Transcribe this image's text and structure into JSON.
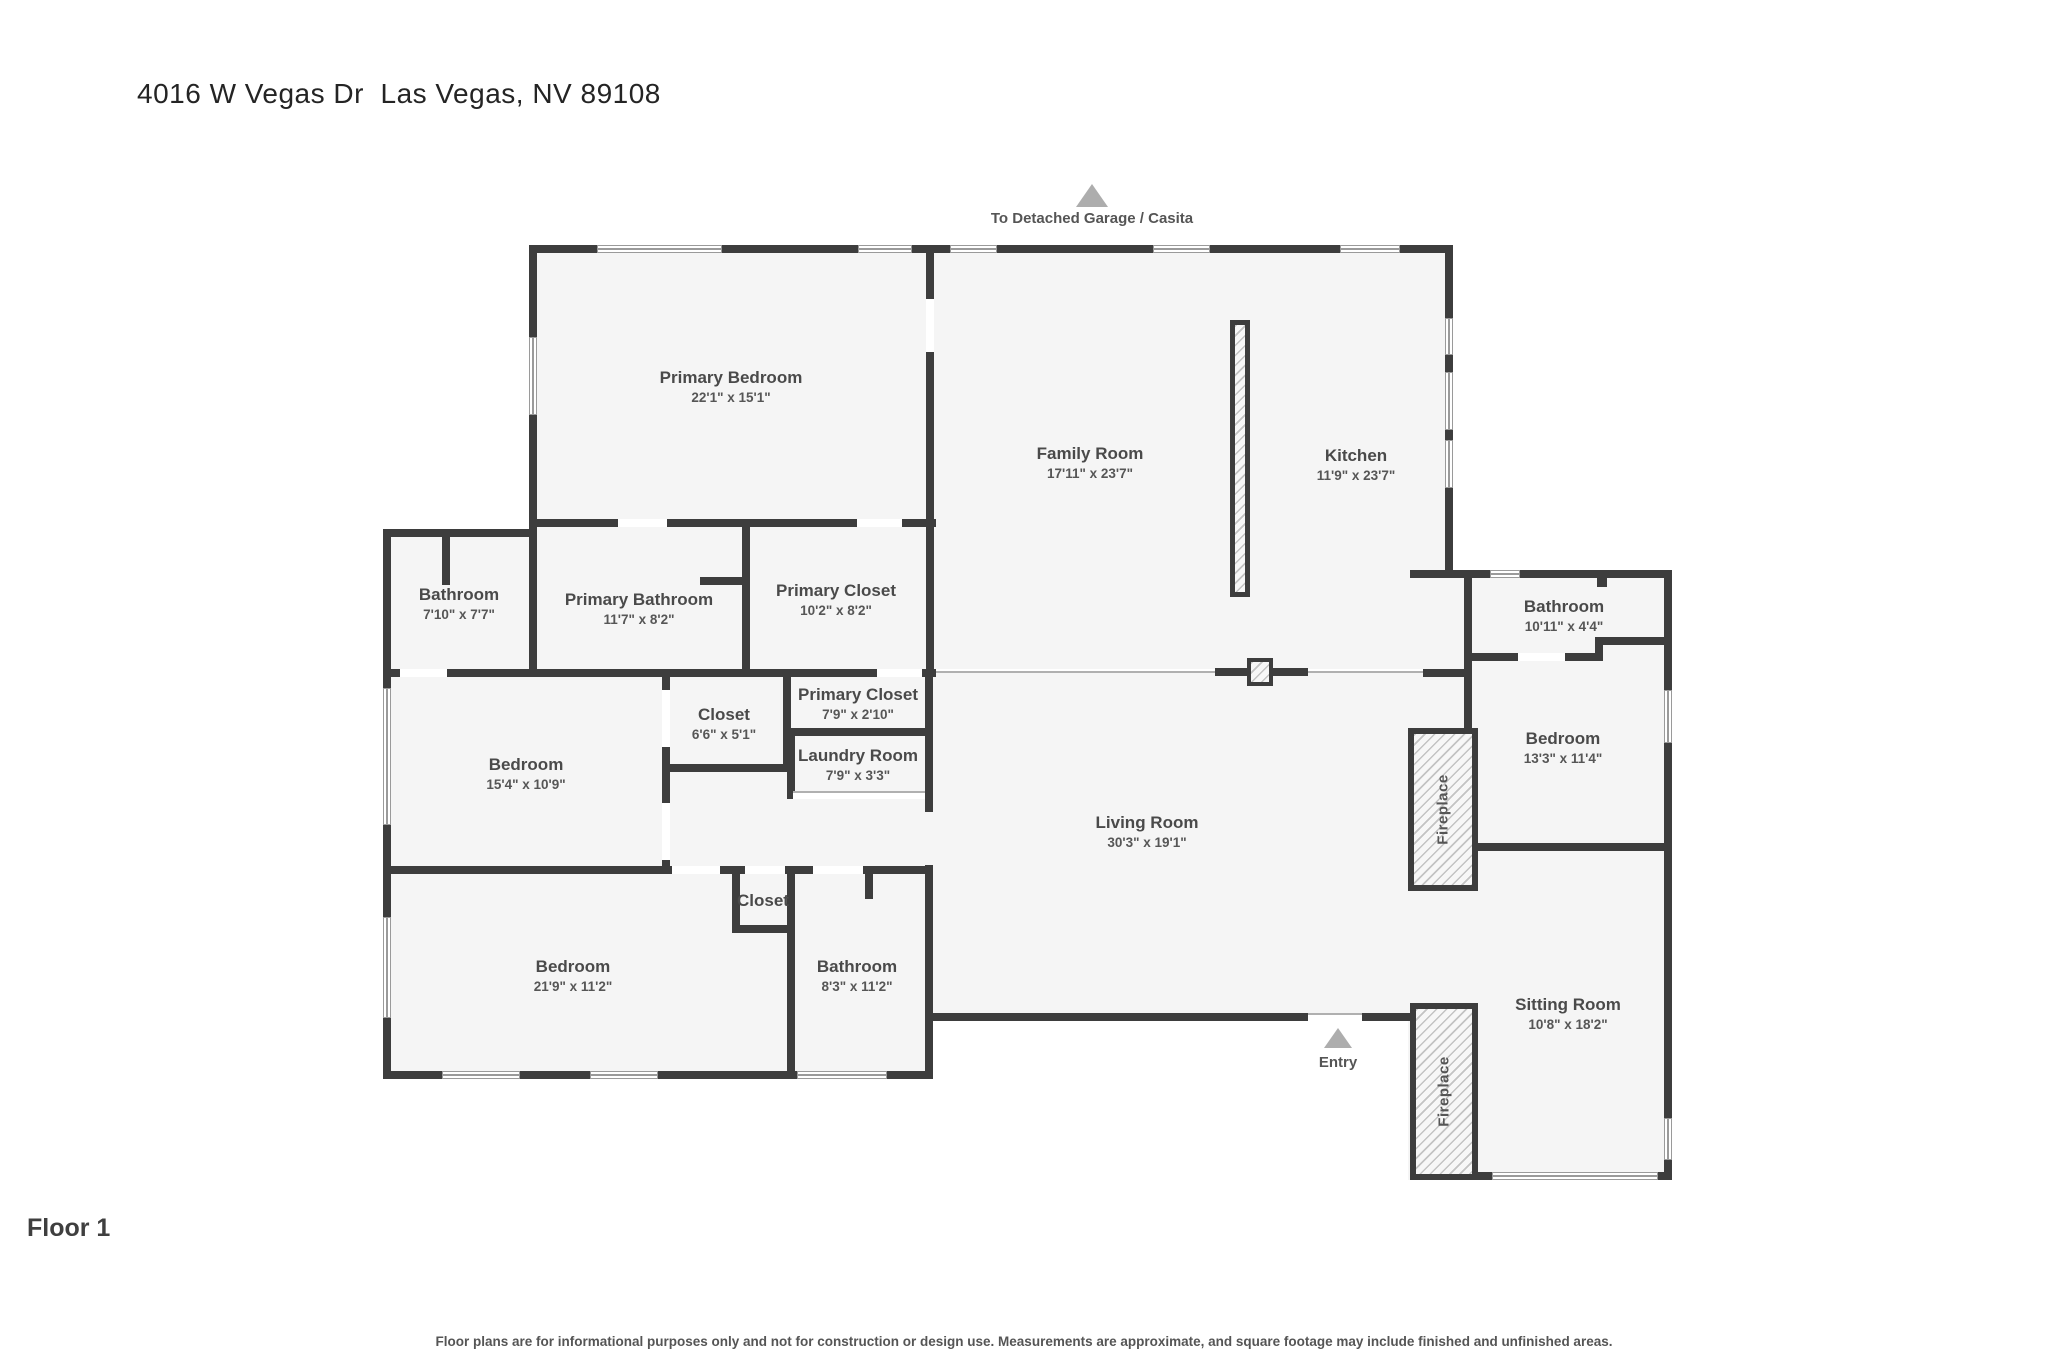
{
  "page": {
    "title": "4016 W Vegas Dr  Las Vegas, NV 89108",
    "floor_label": "Floor 1",
    "disclaimer": "Floor plans are for informational purposes only and not for construction or design use. Measurements are approximate, and square footage may include finished and unfinished areas."
  },
  "annotations": {
    "garage": {
      "label": "To Detached Garage / Casita",
      "icon": "up-triangle"
    },
    "entry": {
      "label": "Entry",
      "icon": "up-triangle"
    }
  },
  "rooms": [
    {
      "name": "Primary Bedroom",
      "dims": "22'1\" x 15'1\""
    },
    {
      "name": "Family Room",
      "dims": "17'11\" x 23'7\""
    },
    {
      "name": "Kitchen",
      "dims": "11'9\" x 23'7\""
    },
    {
      "name": "Bathroom",
      "dims": "7'10\" x 7'7\""
    },
    {
      "name": "Primary Bathroom",
      "dims": "11'7\" x 8'2\""
    },
    {
      "name": "Primary Closet",
      "dims": "10'2\" x 8'2\""
    },
    {
      "name": "Primary Closet",
      "dims": "7'9\" x 2'10\""
    },
    {
      "name": "Closet",
      "dims": "6'6\" x 5'1\""
    },
    {
      "name": "Laundry Room",
      "dims": "7'9\" x 3'3\""
    },
    {
      "name": "Bedroom",
      "dims": "15'4\" x 10'9\""
    },
    {
      "name": "Living Room",
      "dims": "30'3\" x 19'1\""
    },
    {
      "name": "Bathroom",
      "dims": "10'11\" x 4'4\""
    },
    {
      "name": "Bedroom",
      "dims": "13'3\" x 11'4\""
    },
    {
      "name": "Closet",
      "dims": ""
    },
    {
      "name": "Bedroom",
      "dims": "21'9\" x 11'2\""
    },
    {
      "name": "Bathroom",
      "dims": "8'3\" x 11'2\""
    },
    {
      "name": "Sitting Room",
      "dims": "10'8\" x 18'2\""
    }
  ],
  "fireplaces": [
    {
      "label": "Fireplace"
    },
    {
      "label": "Fireplace"
    }
  ],
  "colors": {
    "wall": "#3d3d3d",
    "floor": "#f5f5f5",
    "arrow": "#adadad",
    "label_text": "#4a4a4a"
  }
}
